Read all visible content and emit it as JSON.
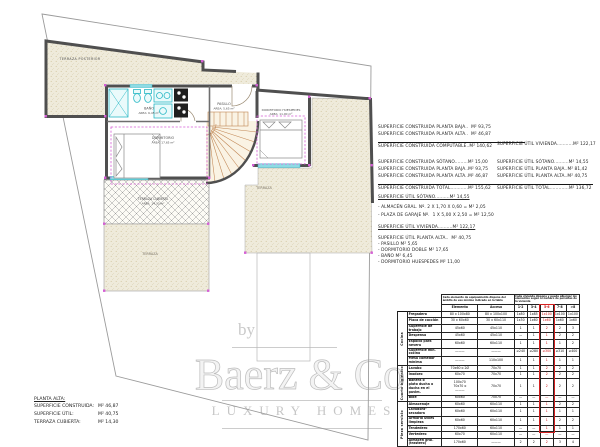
{
  "colors": {
    "wall": "#4f4f4f",
    "fixture_cyan": "#2ab8c5",
    "dimension_magenta": "#d55fd5",
    "stairs_tan": "#c08552",
    "terrace_fill": "#efebdb",
    "highlight_red": "#cc1111",
    "watermark_gray": "#c9c9c9"
  },
  "plan": {
    "labels": {
      "terraza_posterior": "TERRAZA POSTERIOR",
      "bano": "BAÑO",
      "bano_area": "AREA: 6,45 m²",
      "pasillo": "PASILLO",
      "pasillo_area": "AREA: 5,65 m²",
      "dormitorio": "DORMITORIO",
      "dormitorio_area": "AREA: 17,65 m²",
      "huespedes": "DORMITORIO HUESPEDES",
      "huespedes_area": "AREA: 11,00 m²",
      "terraza": "TERRAZA",
      "terraza_cubierta": "TERRAZA CUBIERTA",
      "terraza_cubierta_area": "AREA: 14,30 m²",
      "terraza_lower": "TERRAZA"
    }
  },
  "areas": {
    "computable": {
      "l1": "SUPERFICIE CONSTRUIDA PLANTA BAJA..  M² 93,75",
      "l2": "SUPERFICIE CONSTRUIDA PLANTA ALTA..  M² 46,87",
      "total": "SUPERFICIE CONSTRUIDA COMPUTABLE..M² 140,62"
    },
    "util_vivienda_line": "SUPERFICIE ÚTIL VIVIENDA...........M² 122,17",
    "construida_total": {
      "l1": "SUPERFICIE CONSTRUIDA SÓTANO.........M² 15,00",
      "l2": "SUPERFICIE CONSTRUIDA PLANTA BAJA..M² 93,75",
      "l3": "SUPERFICIE CONSTRUIDA PLANTA ALTA..M² 46,87",
      "total": "SUPERFICIE CONSTRUIDA TOTAL............M² 155,62"
    },
    "util_total": {
      "l1": "SUPERFICIE ÚTIL SÓTANO..........M² 14,55",
      "l2": "SUPERFICIE ÚTIL PLANTA BAJA..M² 81,42",
      "l3": "SUPERFICIE ÚTIL PLANTA ALTA..M² 40,75",
      "total": "SUPERFICIE ÚTIL TOTAL.............M² 136,72"
    },
    "util_sotano": {
      "title": "SUPERFICIE ÚTIL SÓTANO..........M² 14,55",
      "l1": "- ALMACÉN GRAL. Nº. 2 X 1,70 X 0,60 = M² 2,05",
      "l2": "- PLAZA DE GARAJE Nº.  1 X 5,00 X 2,50 = M² 12,50"
    },
    "util_vivienda": {
      "title": "SUPERFICIE ÚTIL VIVIENDA..........M² 122,17",
      "l1": "SUPERFICIE ÚTIL PLANTA ALTA..  M² 40,75",
      "l2": "- PASILLO M² 5,65",
      "l3": "- DORMITORIO DOBLE M² 17,65",
      "l4": "- BAÑO M² 6,45",
      "l5": "- DORMITORIO HUESPEDES M² 11,00"
    }
  },
  "planta_alta_summary": {
    "title": "PLANTA ALTA:",
    "rows": [
      {
        "label": "SUPERFICIE CONSTRUIDA:",
        "value": "M² 46,87"
      },
      {
        "label": "SUPERFICIE ÚTIL:",
        "value": "M² 40,75"
      },
      {
        "label": "TERRAZA CUBIERTA:",
        "value": "M² 14,30"
      }
    ]
  },
  "watermark": {
    "prefix": "by",
    "name": "Baerz & Co",
    "tagline": "LUXURY HOMES"
  },
  "table": {
    "header_note_left": "Cada elemento de equipamiento dispone del ámbito de uso mínimo indicado en la tabla",
    "header_note_right": "Cada vivienda dispone y puede albergar los elementos según el número de personas de la vivienda",
    "col_headers": [
      "Elemento",
      "Acceso",
      "1-2",
      "3-4",
      "5-6",
      "7-8",
      ">8"
    ],
    "highlight_col": "5-6",
    "groups": [
      {
        "name": "Cocina",
        "rows": [
          {
            "label": "Fregadero",
            "elemento": "80 x 100x80",
            "acceso": "80 x 100x100",
            "v": [
              "1x80",
              "1x85",
              "1x100",
              "1x100",
              "1x100"
            ]
          },
          {
            "label": "Placa de cocción",
            "elemento": "30 x 60x60",
            "acceso": "30 x 60x110",
            "v": [
              "1x30",
              "1x60",
              "1x60",
              "1x60",
              "1x60"
            ]
          },
          {
            "label": "Superficie de trabajo",
            "elemento": "45x60",
            "acceso": "45x110",
            "v": [
              "1",
              "1",
              "2",
              "2",
              "3"
            ]
          },
          {
            "label": "Despensa",
            "elemento": "45x60",
            "acceso": "45x110",
            "v": [
              "—",
              "1",
              "1",
              "2",
              "2"
            ]
          },
          {
            "label": "Espacio para nevera",
            "elemento": "60x60",
            "acceso": "60x110",
            "v": [
              "1",
              "1",
              "1",
              "1",
              "2"
            ]
          },
          {
            "label": "Superficie mín. cocina",
            "elemento": "———",
            "acceso": "———",
            "v": [
              "≥240",
              "≥280",
              "≥300",
              "≥310",
              "≥400"
            ]
          },
          {
            "label": "Mesa comedor mínima",
            "elemento": "———",
            "acceso": "110x100",
            "v": [
              "1",
              "1",
              "1",
              "1",
              "1"
            ]
          }
        ]
      },
      {
        "name": "Cuarto higiénico",
        "rows": [
          {
            "label": "Lavabo",
            "elemento": "70x60 o 2Ø",
            "acceso": "70x70",
            "v": [
              "1",
              "1",
              "2",
              "2",
              "2"
            ]
          },
          {
            "label": "Inodoro",
            "elemento": "60x70",
            "acceso": "70x70",
            "v": [
              "1",
              "1",
              "2",
              "2",
              "2"
            ]
          },
          {
            "label": "Bañera o\nplato ducha o\nducha en el pavim.",
            "elemento": "100x70\n70x70 o\n———",
            "acceso": "70x70",
            "v": [
              "1",
              "1",
              "2",
              "2",
              "2"
            ],
            "tall": true
          },
          {
            "label": "Bidé",
            "elemento": "60x60",
            "acceso": "70x70",
            "v": [
              "—",
              "—",
              "—",
              "—",
              "—"
            ]
          }
        ]
      },
      {
        "name": "Pieza servicio",
        "rows": [
          {
            "label": "Almacenaje",
            "elemento": "60x60",
            "acceso": "60x110",
            "v": [
              "1",
              "1",
              "1",
              "2",
              "2"
            ]
          },
          {
            "label": "Lavadora-secadora",
            "elemento": "60x60",
            "acceso": "60x110",
            "v": [
              "1",
              "1",
              "1",
              "1",
              "1"
            ]
          },
          {
            "label": "Armario útiles limpieza",
            "elemento": "60x60",
            "acceso": "60x110",
            "v": [
              "1",
              "1",
              "1",
              "2",
              "2"
            ]
          },
          {
            "label": "Tendedero",
            "elemento": "170x60",
            "acceso": "60x110",
            "v": [
              "—",
              "—",
              "1",
              "1",
              "1"
            ]
          },
          {
            "label": "Vertedero",
            "elemento": "60x70",
            "acceso": "60x110",
            "v": [
              "—",
              "—",
              "—",
              "—",
              "—"
            ]
          },
          {
            "label": "Almacén gral. (trastero)",
            "elemento": "170x60",
            "acceso": "———",
            "v": [
              "2",
              "2",
              "2",
              "3",
              "4"
            ]
          }
        ]
      }
    ]
  }
}
